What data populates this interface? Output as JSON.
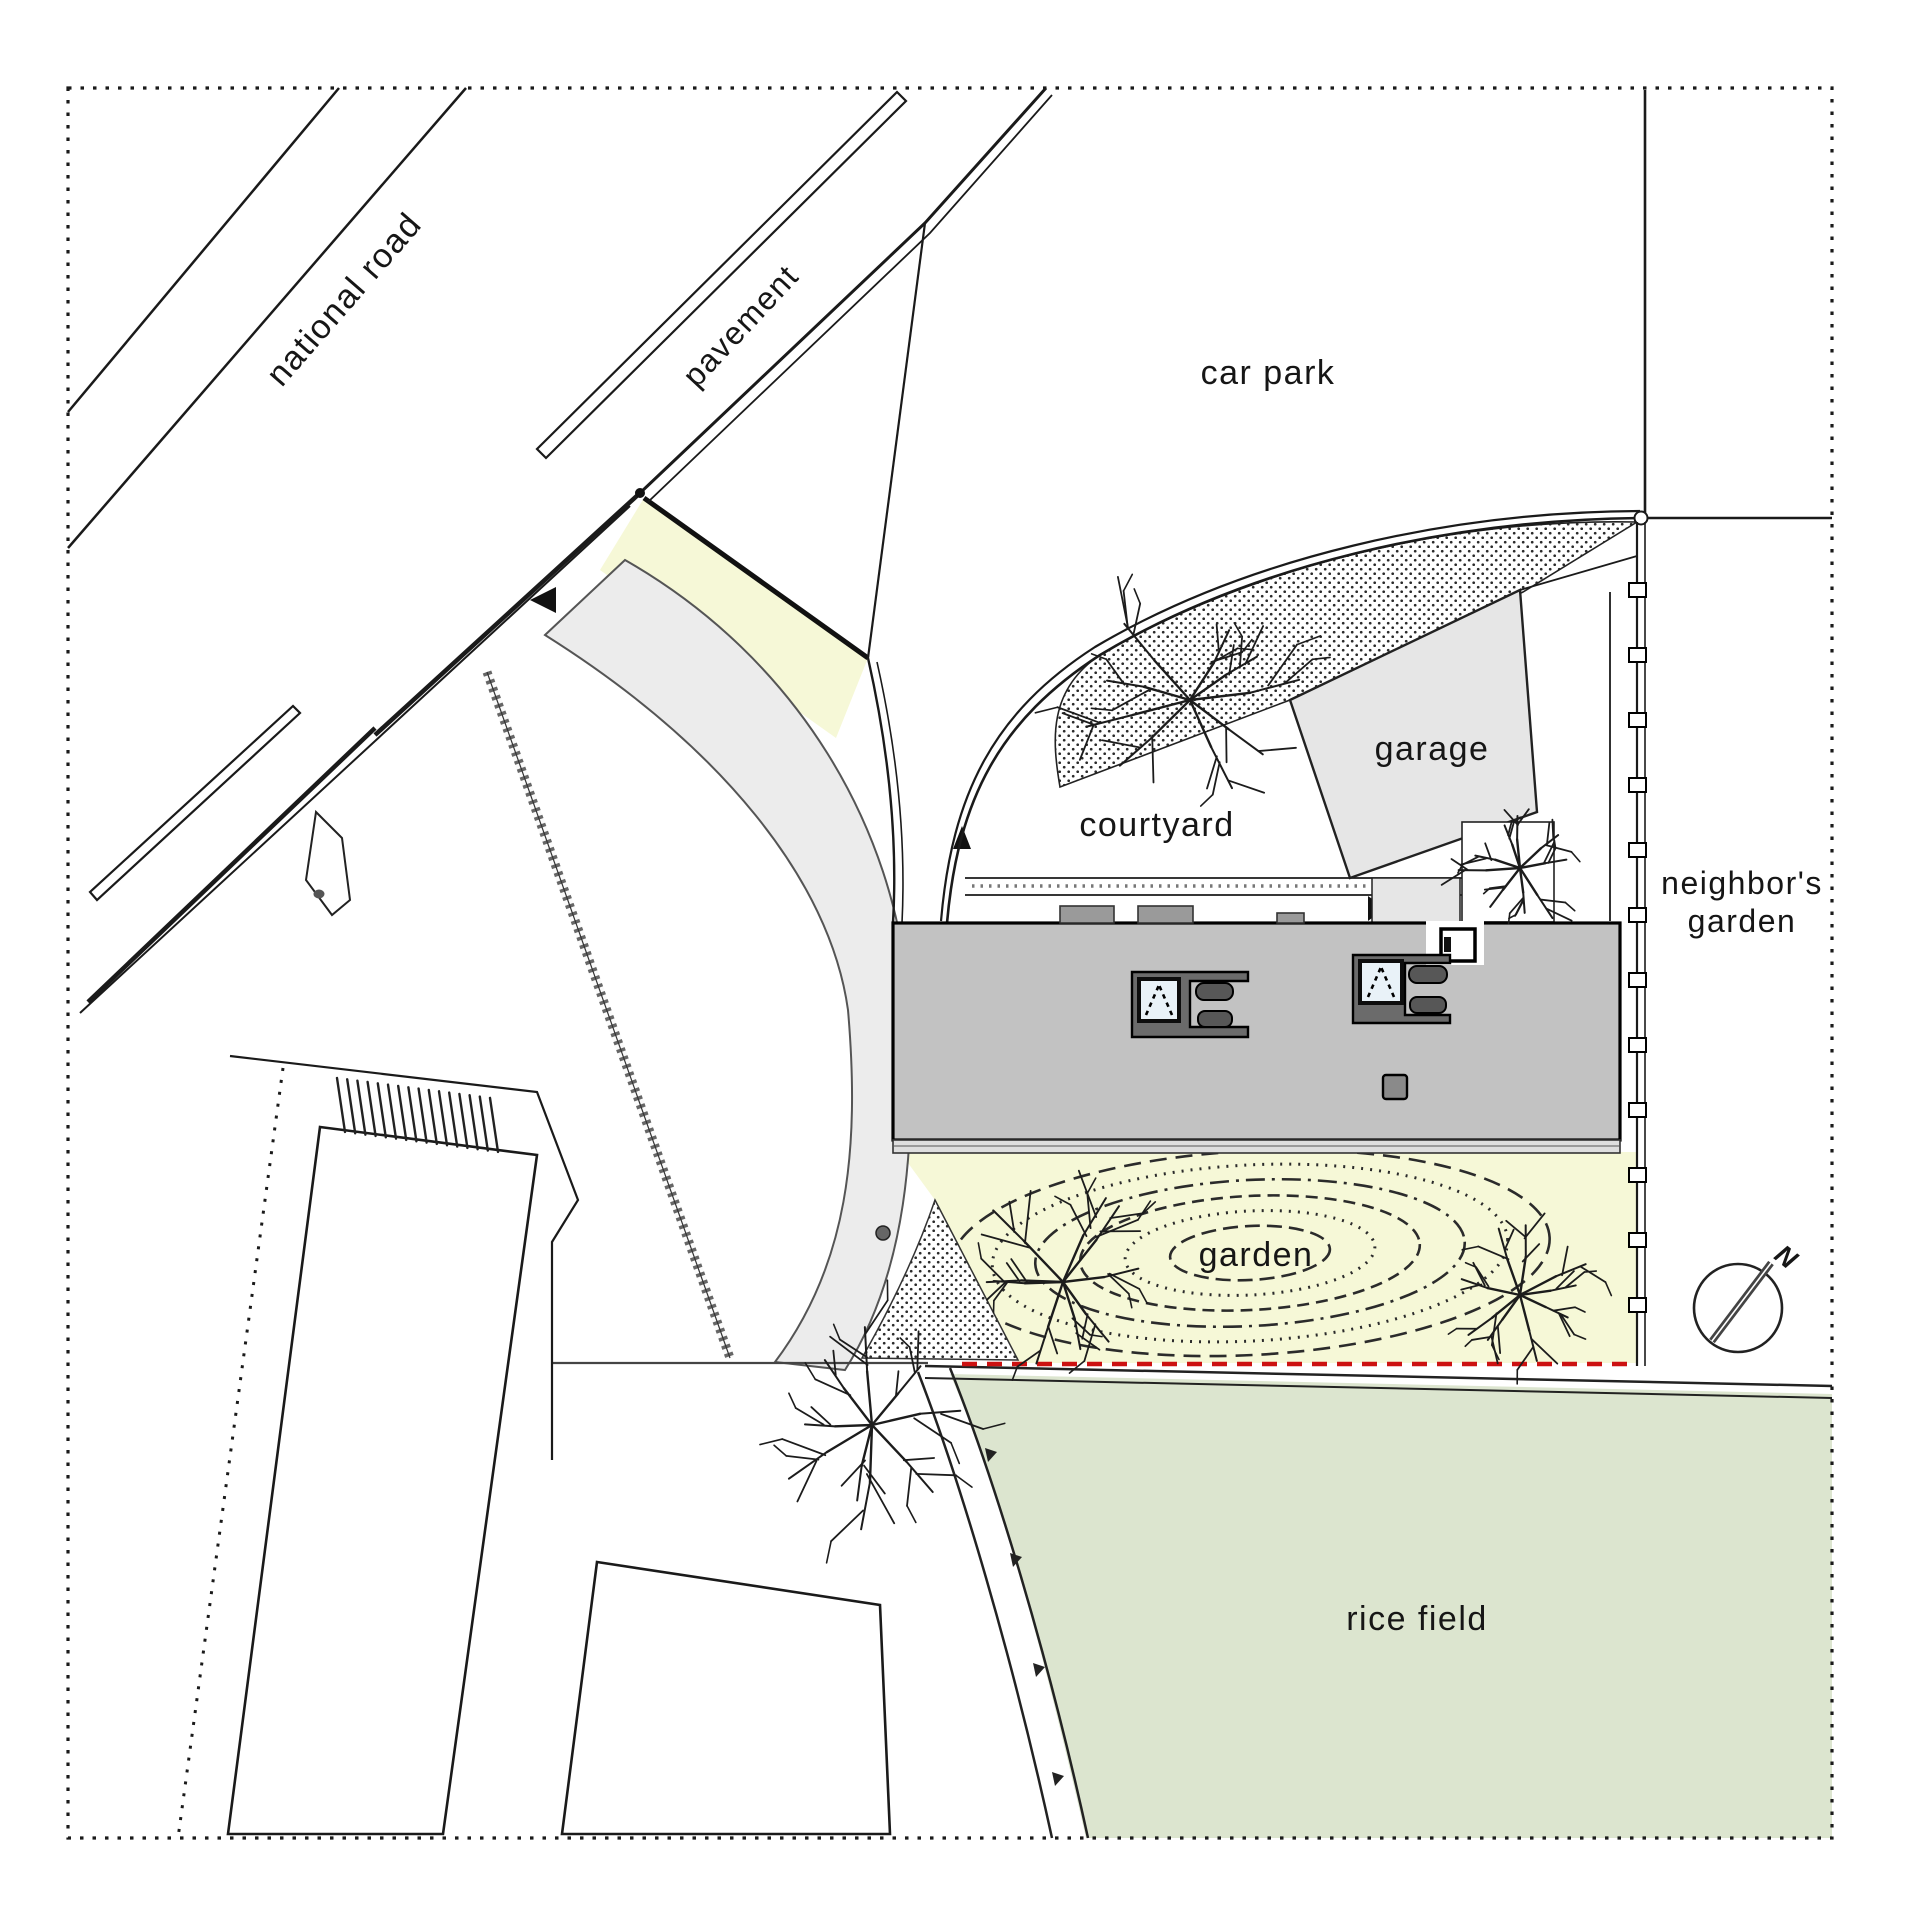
{
  "plan": {
    "type": "architectural-site-plan",
    "labels": {
      "national_road": "national road",
      "pavement": "pavement",
      "car_park": "car park",
      "garage": "garage",
      "courtyard": "courtyard",
      "neighbors_garden_line1": "neighbor's",
      "neighbors_garden_line2": "garden",
      "garden": "garden",
      "rice_field": "rice field"
    },
    "compass": {
      "label": "N",
      "icon": "north-arrow-icon"
    },
    "colors": {
      "background": "#ffffff",
      "line": "#1a1a1a",
      "building_roof": "#c2c2c2",
      "roof_feature_dark": "#666666",
      "skylight": "#e9f2f8",
      "garage_fill": "#e6e6e6",
      "driveway_fill": "#ececec",
      "garden_fill": "#f6f8d7",
      "entrance_wedge_fill": "#f6f8d7",
      "rice_field_fill": "#dce5cf",
      "boundary_red": "#cc1111"
    },
    "symbols": [
      "site-boundary-dotted-border",
      "fence-posts",
      "terrain-contour-ellipses",
      "deciduous-trees",
      "stippled-paving",
      "north-arrow"
    ]
  }
}
